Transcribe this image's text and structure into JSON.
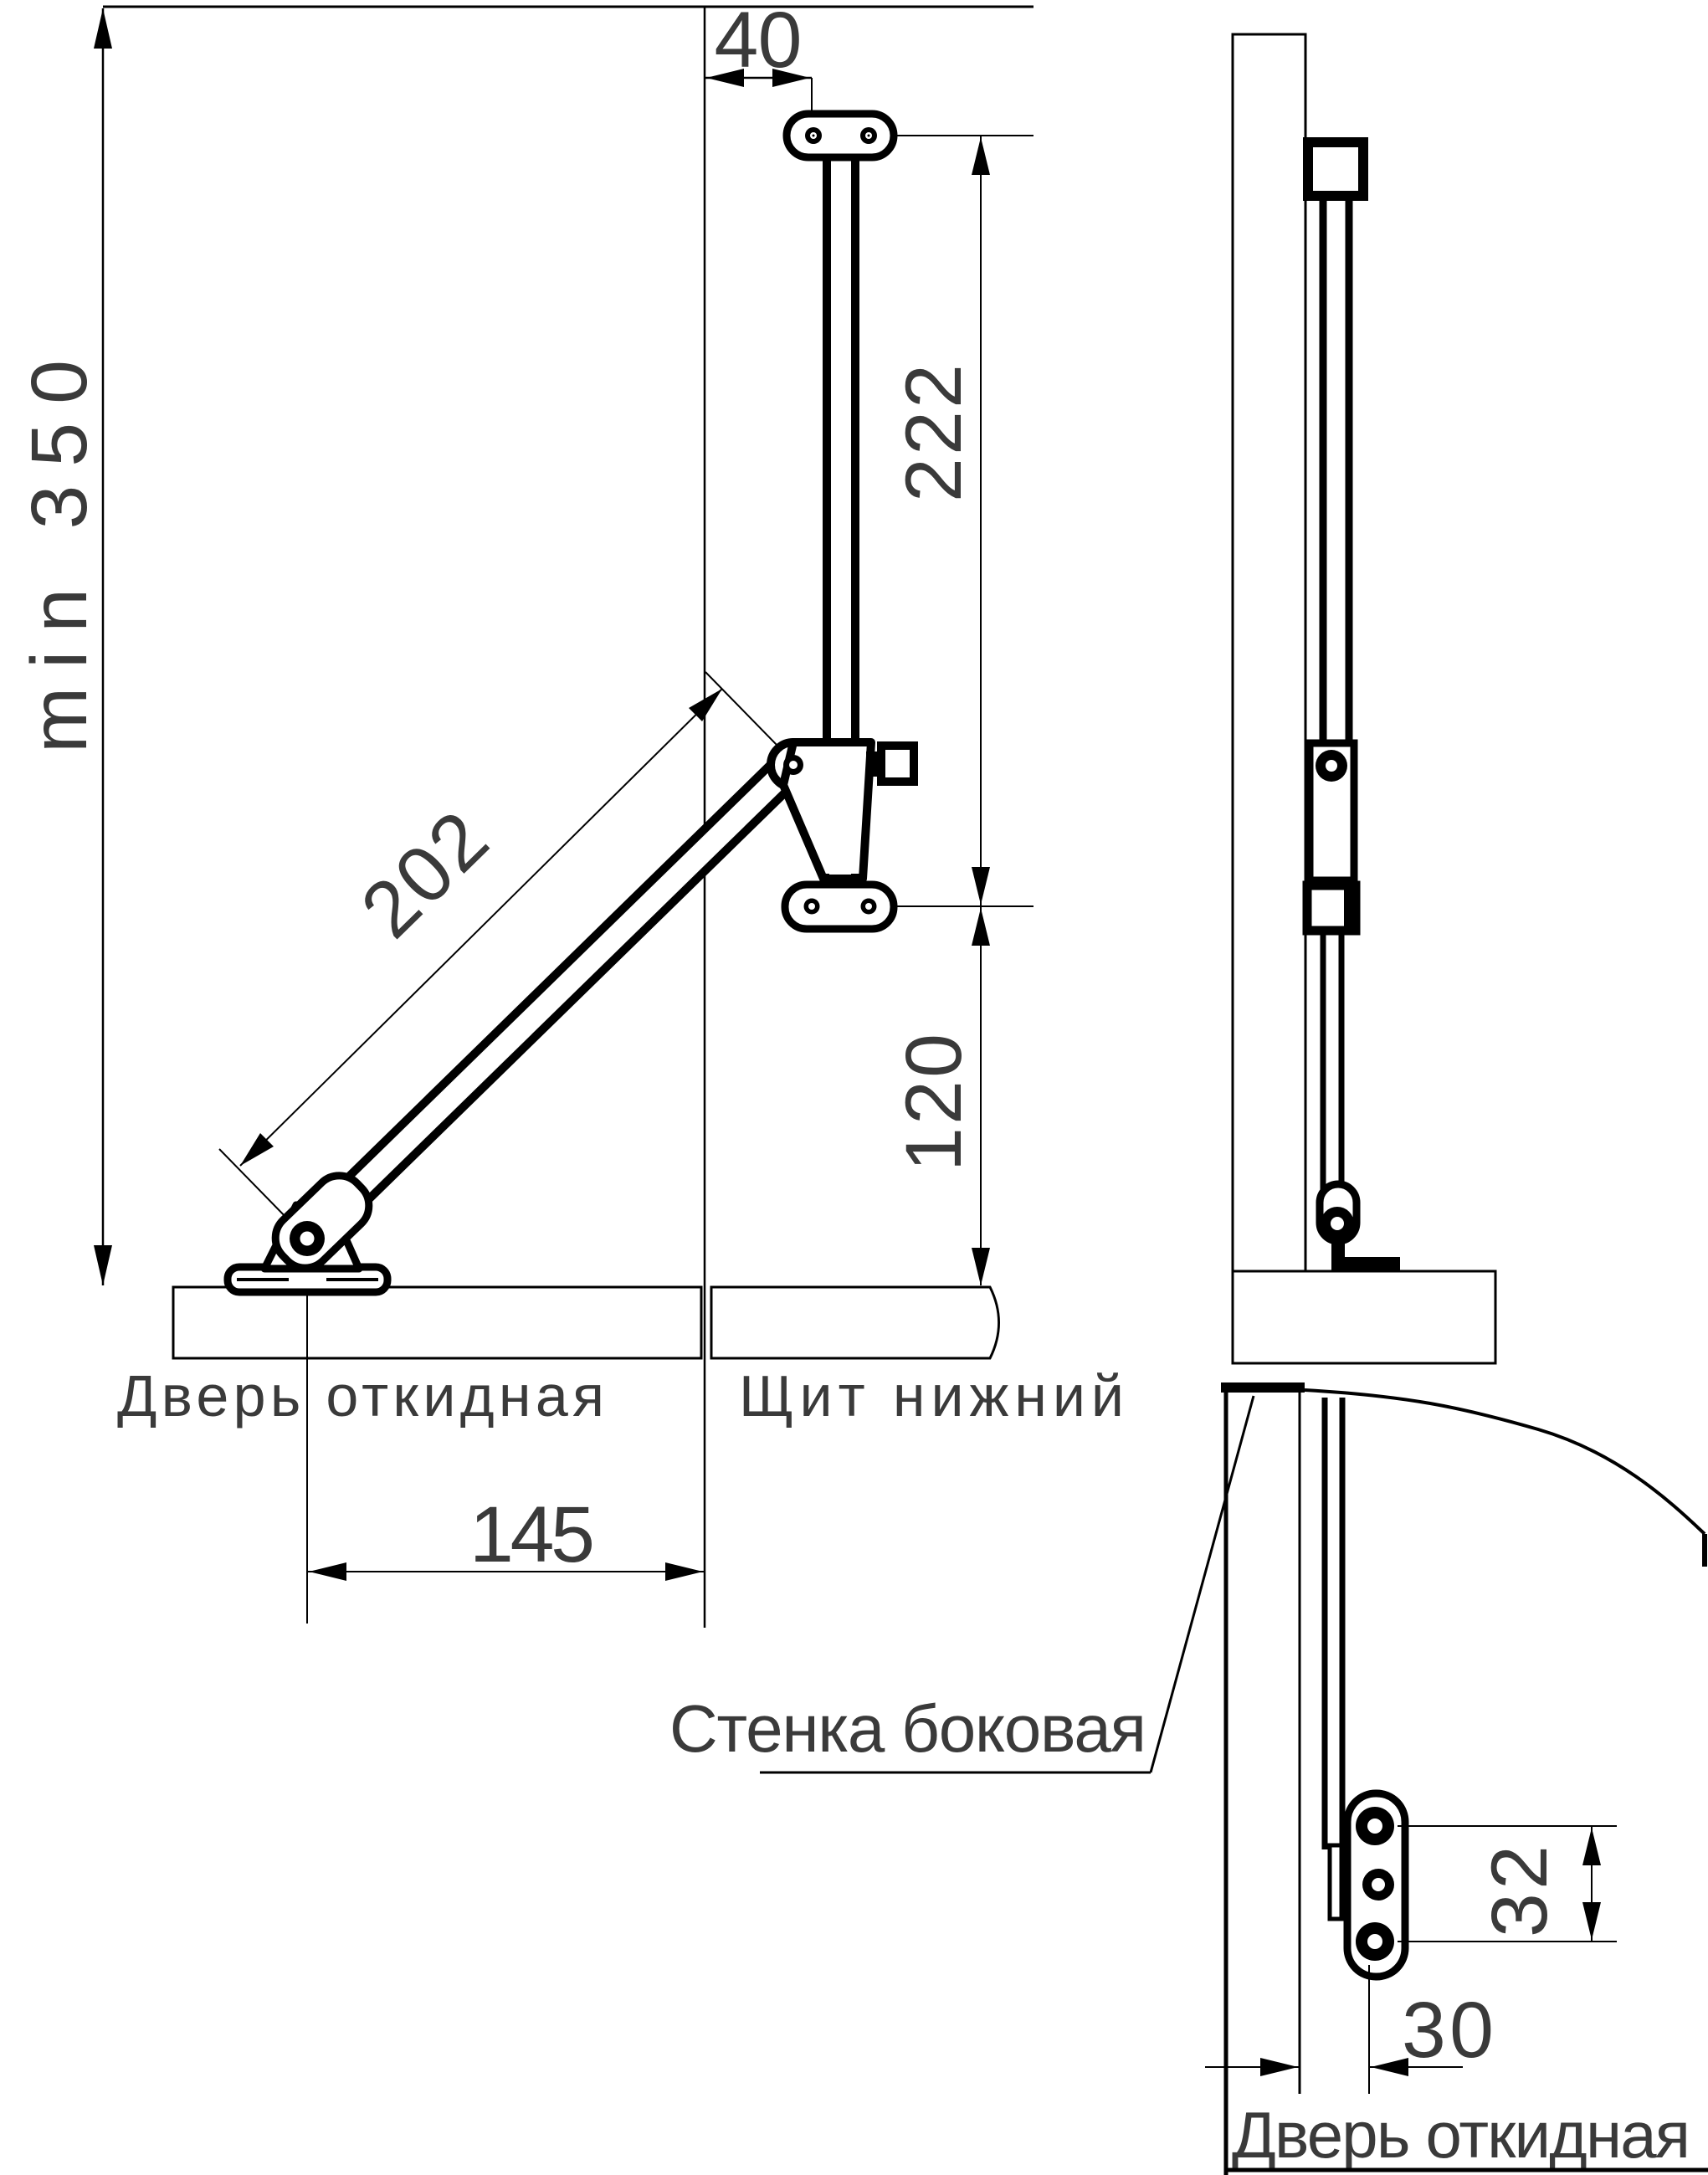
{
  "page": {
    "background": "#ffffff"
  },
  "drawing": {
    "colors": {
      "line": "#000000",
      "text": "#3a3a3a"
    },
    "front_view": {
      "dim_min_height": "min 350",
      "dim_top_offset": "40",
      "dim_upper_section": "222",
      "dim_strut_length": "202",
      "dim_lower_section": "120",
      "dim_pivot_offset": "145",
      "label_flip_door": "Дверь откидная",
      "label_bottom_panel": "Щит нижний"
    },
    "detail_view": {
      "label_side_wall": "Стенка боковая",
      "dim_hole_spacing": "32",
      "dim_plate_offset": "30",
      "label_flip_door": "Дверь откидная"
    }
  }
}
